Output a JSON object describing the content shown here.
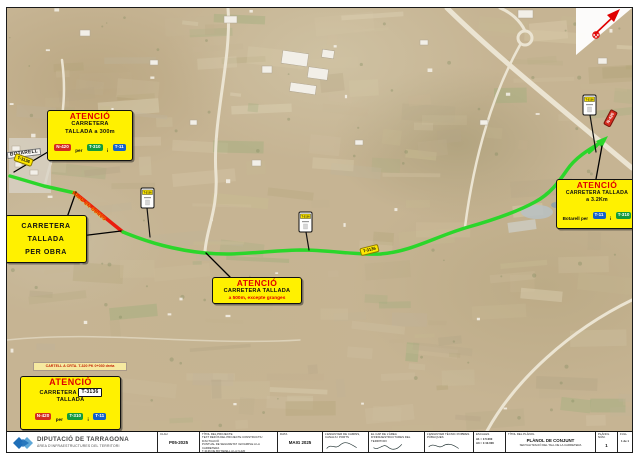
{
  "map": {
    "place_label": "BOTARELL",
    "route_pill_a": "T-3136",
    "route_pill_b": "T-3136",
    "highway_pill": "N-420",
    "works_text": "TRAM EN OBRES",
    "km_sign_road": "T-3136"
  },
  "labels": {
    "b1": {
      "title": "ATENCIÓ",
      "l2": "CARRETERA",
      "l3": "TALLADA a 300m",
      "badge1": "N-420",
      "mid": "per",
      "badge2": "T-310",
      "sep": "i",
      "badge3": "T-11"
    },
    "b2": {
      "l1": "CARRETERA",
      "l2": "TALLADA",
      "l3": "PER OBRA"
    },
    "b3": {
      "title": "ATENCIÓ",
      "l2": "CARRETERA TALLADA",
      "l3": "a 500m, excepte granges"
    },
    "b4": {
      "title": "ATENCIÓ",
      "l2": "CARRETERA TALLADA",
      "l3": "a 3.2Km",
      "via_pre": "Botarell per",
      "badge1": "T-11",
      "sep": "i",
      "badge2": "T-310"
    },
    "b5": {
      "note": "CARTELL A CRTA. T-320 PK 0+030 dreta",
      "title": "ATENCIÓ",
      "l2a": "CARRETERA",
      "road_badge": "T-3136",
      "l3": "TALLADA",
      "badge1": "N-420",
      "mid": "per",
      "badge2": "T-310",
      "sep": "i",
      "badge3": "T-11"
    }
  },
  "titleblock": {
    "org_name": "DIPUTACIÓ DE TARRAGONA",
    "org_sub": "ÀREA D'INFRAESTRUCTURES DEL TERRITORI",
    "clau_label": "CLAU",
    "clau_value": "P05-2025",
    "project_label": "TÍTOL DEL PROJECTE",
    "project_line1": "TEXT REFÓS DEL PROJECTE CONSTRUCTIU D'ACTUACIÓ",
    "project_line2": "PUNTUAL DE SEGURETAT I EIXAMPLE A LA CARRETERA",
    "project_line3": "T-3136 DE BOTARELL A LA N-420",
    "date_label": "DATA",
    "date_value": "MAIG 2025",
    "sig1": "L'ENGINYER DE CAMINS, CANALS I PORTS",
    "sig2": "EL CAP DE L'ÀREA D'INFRAESTRUCTURES DEL TERRITORI",
    "sig3": "L'ENGINYER TÈCNIC D'OBRES PÚBLIQUES",
    "scales_label": "ESCALES",
    "scale_a1": "A1 = 1:5.000",
    "scale_a3": "A3 = 1:10.000",
    "plan_title_label": "TÍTOL DEL PLÀNOL",
    "plan_title": "PLÀNOL DE CONJUNT",
    "plan_subtitle": "SENYALITZACIÓ DEL TALL DE LA CARRETERA",
    "plan_num_label": "PLÀNOL NÚM.",
    "plan_num": "1",
    "full_label": "FULL",
    "full_value": "1 de 1"
  },
  "colors": {
    "label_yellow": "#FFF100",
    "attention_red": "#E00000",
    "route_green": "#2BD62B",
    "route_red": "#EA1C0D",
    "badge_red": "#D42B1E",
    "badge_green": "#149A3C",
    "badge_blue": "#1460C8",
    "logo_blue": "#1F6FB8"
  }
}
